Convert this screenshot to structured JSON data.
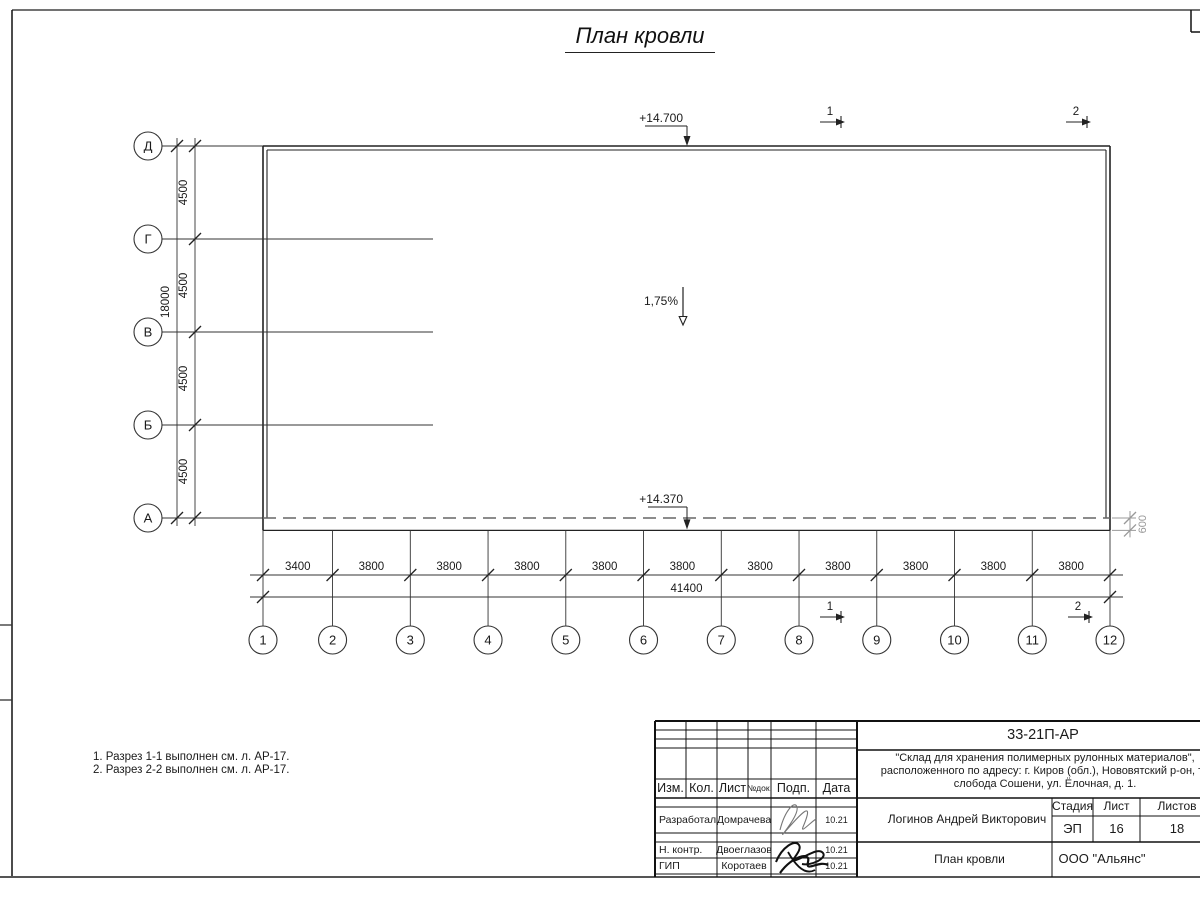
{
  "title": "План кровли",
  "plan": {
    "row_labels": [
      "Д",
      "Г",
      "В",
      "Б",
      "А"
    ],
    "row_spacings": [
      4500,
      4500,
      4500,
      4500
    ],
    "row_total": 18000,
    "col_labels": [
      "1",
      "2",
      "3",
      "4",
      "5",
      "6",
      "7",
      "8",
      "9",
      "10",
      "11",
      "12"
    ],
    "col_spacings": [
      3400,
      3800,
      3800,
      3800,
      3800,
      3800,
      3800,
      3800,
      3800,
      3800,
      3800
    ],
    "col_total": 41400,
    "overhang": 600,
    "elevation_top": "+14.700",
    "elevation_bottom": "+14.370",
    "slope": "1,75%",
    "sections": [
      "1",
      "2"
    ]
  },
  "notes": [
    "1. Разрез 1-1 выполнен см. л. АР-17.",
    "2. Разрез 2-2 выполнен см. л. АР-17."
  ],
  "titleblock": {
    "doc_number": "33-21П-АР",
    "project_lines": [
      "\"Склад для хранения полимерных рулонных материалов\",",
      "расположенного по адресу: г. Киров (обл.), Нововятский р-он, те",
      "слобода Сошени, ул. Ёлочная, д. 1."
    ],
    "header_cols": [
      "Изм.",
      "Кол.",
      "Лист",
      "№док.",
      "Подп.",
      "Дата"
    ],
    "people": [
      {
        "role": "Разработал",
        "name": "Домрачева",
        "date": "10.21"
      },
      {
        "role": "Н. контр.",
        "name": "Двоеглазов",
        "date": "10.21"
      },
      {
        "role": "ГИП",
        "name": "Коротаев",
        "date": "10.21"
      }
    ],
    "chief": "Логинов Андрей Викторович",
    "stage_header": [
      "Стадия",
      "Лист",
      "Листов"
    ],
    "stage_values": [
      "ЭП",
      "16",
      "18"
    ],
    "drawing_name": "План кровли",
    "company": "ООО \"Альянс\""
  }
}
